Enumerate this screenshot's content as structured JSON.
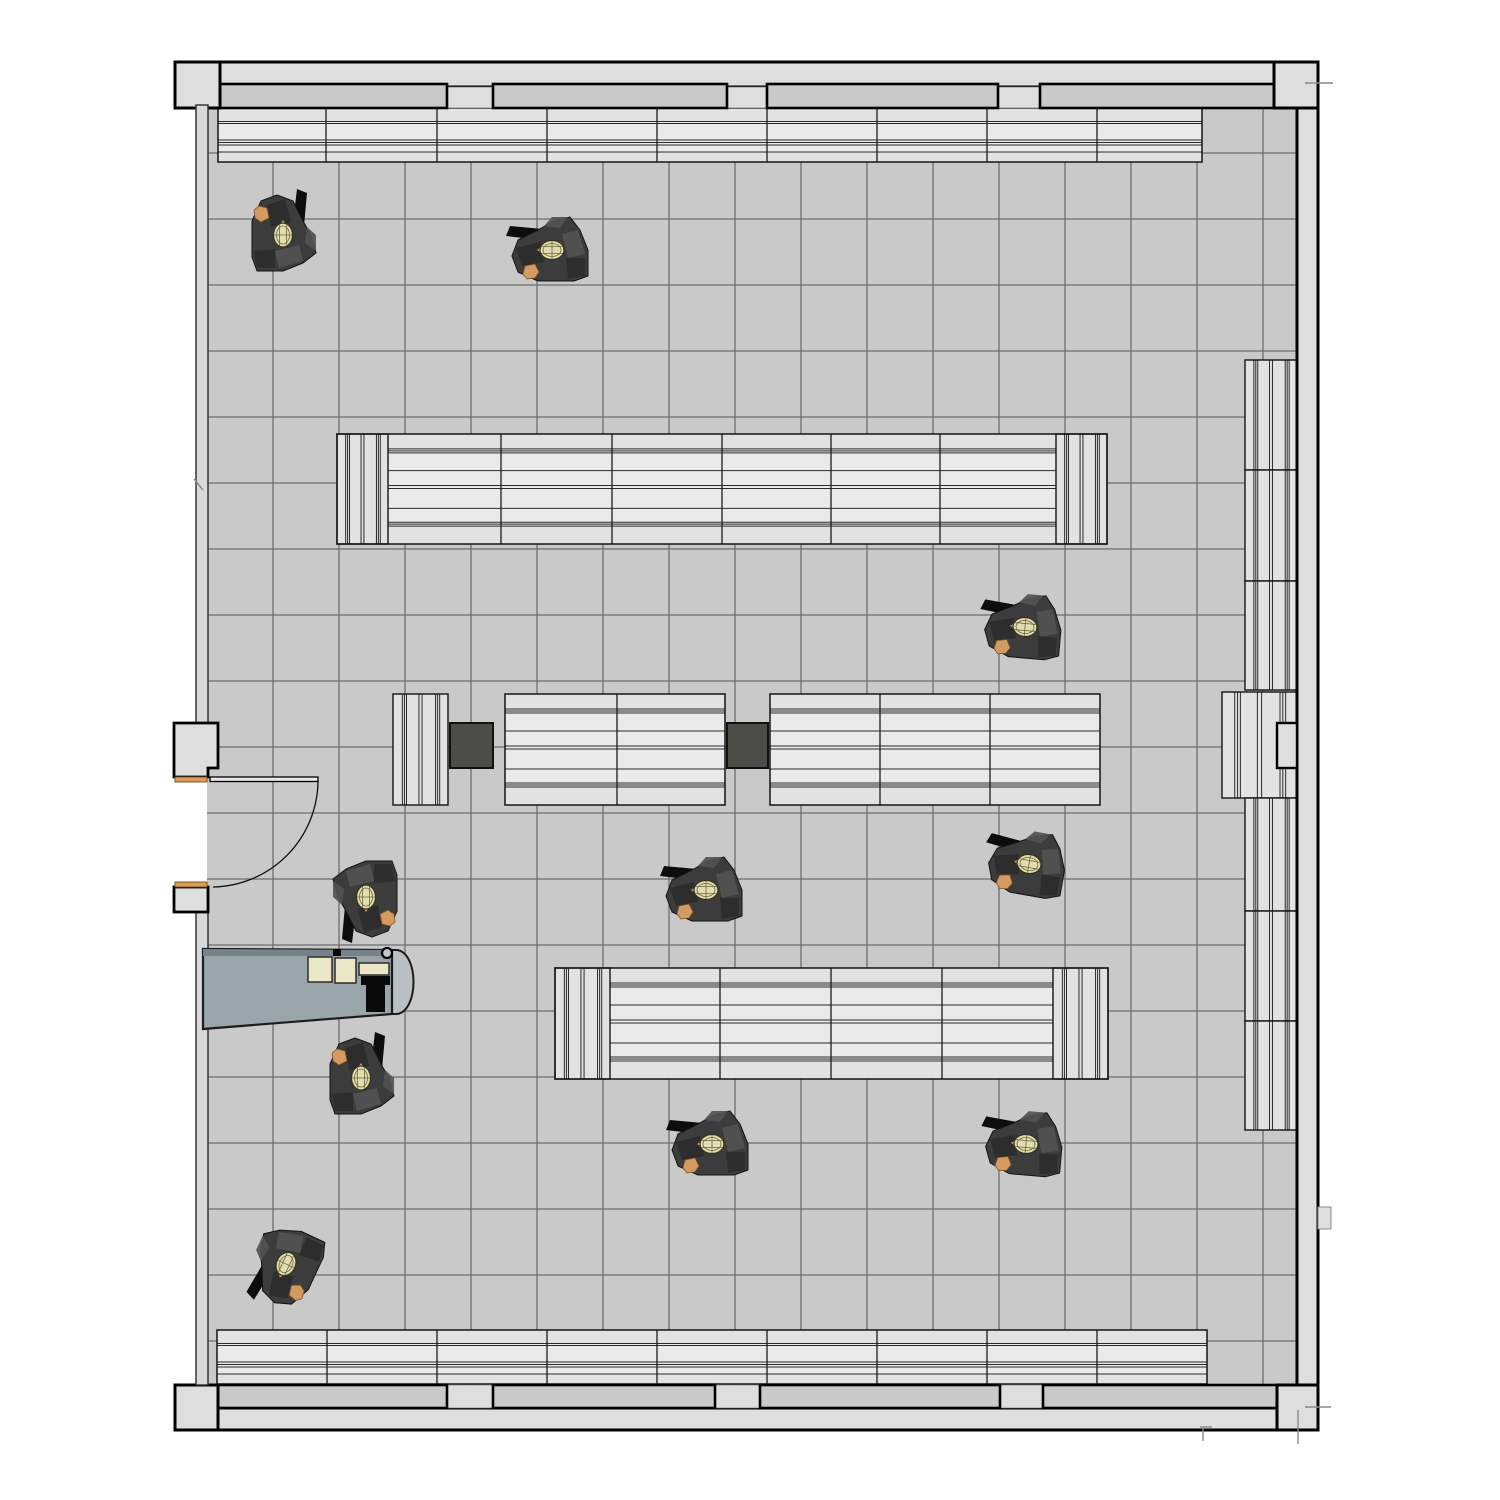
{
  "scene": {
    "width": 1500,
    "height": 1500
  },
  "colors": {
    "bg": "#ffffff",
    "floor": "#c9c9c9",
    "grid": "#565656",
    "wall_fill": "#dedede",
    "wall_stroke": "#000000",
    "pillar_fill": "#c9c9c9",
    "left_wall_fill": "#d9d9d9",
    "shelf_fill": "#e2e2e2",
    "shelf_inner": "#eaeaea",
    "shelf_stroke": "#141414",
    "shelf_line": "#2b2b2b",
    "dark_block": "#4c4c49",
    "desk_fill": "#9aa5a9",
    "desk_edge": "#77838a",
    "desk_cap": "#b9bfc2",
    "desk_stroke": "#1c1c1c",
    "cream": "#ebe6c5",
    "black": "#0a0a0a",
    "door_frame_orange": "#d99e5e",
    "person_body": "#3c3c3c",
    "person_body_light": "#525252",
    "person_body_dark": "#2c2c2c",
    "person_head": "#e1ddae",
    "person_head_line": "#6b663c",
    "person_hand": "#d49b61",
    "person_arm": "#0d0d0d",
    "tick": "#8a8a8a"
  },
  "floor": {
    "x": 207,
    "y": 87,
    "w": 1090,
    "h": 1321,
    "grid_x0": 273,
    "grid_x1": 1263,
    "grid_y0": 153,
    "grid_y1": 1341,
    "step": 66,
    "top": 108,
    "bottom": 1385,
    "left": 207,
    "right": 1297
  },
  "walls": {
    "bands": [
      [
        175,
        62,
        1143,
        25
      ],
      [
        1297,
        62,
        21,
        1368
      ],
      [
        175,
        1408,
        1143,
        22
      ]
    ],
    "corner_blocks": [
      [
        175,
        62,
        45,
        46
      ],
      [
        1274,
        62,
        44,
        46
      ],
      [
        175,
        1385,
        43,
        45
      ],
      [
        1277,
        1385,
        41,
        45
      ]
    ],
    "notch_blocks": [
      [
        1277,
        723,
        20,
        45
      ]
    ],
    "pillars_top": [
      [
        220,
        84,
        227,
        24
      ],
      [
        493,
        84,
        234,
        24
      ],
      [
        767,
        84,
        231,
        24
      ],
      [
        1040,
        84,
        234,
        24
      ]
    ],
    "pillars_bottom": [
      [
        218,
        1385,
        229,
        23
      ],
      [
        493,
        1385,
        222,
        23
      ],
      [
        760,
        1385,
        240,
        23
      ],
      [
        1043,
        1385,
        234,
        23
      ]
    ],
    "gap_strips": [
      [
        447,
        87,
        46,
        21
      ],
      [
        727,
        87,
        40,
        21
      ],
      [
        998,
        87,
        42,
        21
      ],
      [
        1274,
        87,
        23,
        21
      ],
      [
        447,
        1385,
        46,
        23
      ],
      [
        715,
        1385,
        45,
        23
      ],
      [
        1000,
        1385,
        43,
        23
      ]
    ],
    "left_wall": [
      [
        196,
        105,
        12,
        618
      ],
      [
        196,
        909,
        12,
        476
      ]
    ],
    "entry_box_top_poly": [
      [
        174,
        723
      ],
      [
        218,
        723
      ],
      [
        218,
        768
      ],
      [
        208,
        768
      ],
      [
        208,
        777
      ],
      [
        174,
        777
      ]
    ],
    "entry_box_bottom": [
      174,
      887,
      34,
      25
    ],
    "door_frame_strips": [
      [
        175,
        777,
        32,
        5
      ],
      [
        175,
        882,
        32,
        5
      ]
    ],
    "outside_block": [
      1318,
      1207,
      13,
      22
    ],
    "ticks": [
      [
        1305,
        83,
        1333,
        83
      ],
      [
        194,
        479,
        203,
        490
      ],
      [
        1200,
        1427,
        1212,
        1427
      ],
      [
        1203,
        1427,
        1203,
        1441
      ],
      [
        1298,
        1410,
        1298,
        1444
      ],
      [
        1305,
        1407,
        1331,
        1407
      ]
    ]
  },
  "door": {
    "leaf": [
      210,
      777,
      108,
      4.5
    ],
    "arc_from": [
      318,
      781
    ],
    "arc_to": [
      213,
      887
    ],
    "radius": 107
  },
  "patterns": {
    "short": {
      "ref": 54,
      "lines": [
        13.5,
        15.5,
        32,
        34.5,
        37,
        44
      ]
    },
    "tall": {
      "ref": 111,
      "lines": [
        15,
        17,
        19,
        37,
        52,
        55,
        75,
        89,
        91,
        93
      ]
    },
    "cap": {
      "ref": 53,
      "lines": [
        9,
        11,
        13,
        25,
        28,
        41,
        43,
        45
      ]
    }
  },
  "shelves_h": [
    {
      "x": 218,
      "y": 108,
      "w": 984,
      "h": 54,
      "capL": false,
      "capR": false,
      "capW": 0,
      "dividers": [
        326,
        437,
        547,
        657,
        767,
        877,
        987,
        1097
      ],
      "pattern": "short"
    },
    {
      "x": 337,
      "y": 434,
      "w": 770,
      "h": 110,
      "capL": true,
      "capR": true,
      "capW": 51,
      "dividers": [
        501,
        612,
        722,
        831,
        940
      ],
      "pattern": "tall"
    },
    {
      "x": 505,
      "y": 694,
      "w": 220,
      "h": 111,
      "capL": false,
      "capR": false,
      "capW": 0,
      "dividers": [
        617
      ],
      "pattern": "tall"
    },
    {
      "x": 770,
      "y": 694,
      "w": 330,
      "h": 111,
      "capL": false,
      "capR": false,
      "capW": 0,
      "dividers": [
        880,
        990
      ],
      "pattern": "tall"
    },
    {
      "x": 555,
      "y": 968,
      "w": 553,
      "h": 111,
      "capL": true,
      "capR": true,
      "capW": 55,
      "dividers": [
        720,
        831,
        942
      ],
      "pattern": "tall"
    },
    {
      "x": 217,
      "y": 1330,
      "w": 990,
      "h": 54,
      "capL": false,
      "capR": false,
      "capW": 0,
      "dividers": [
        327,
        437,
        547,
        657,
        767,
        877,
        987,
        1097
      ],
      "pattern": "short"
    }
  ],
  "shelves_v": [
    {
      "x": 393,
      "y": 694,
      "w": 55,
      "h": 111
    },
    {
      "x": 1245,
      "y": 360,
      "w": 52,
      "h": 110
    },
    {
      "x": 1245,
      "y": 470,
      "w": 52,
      "h": 111
    },
    {
      "x": 1245,
      "y": 581,
      "w": 52,
      "h": 109
    },
    {
      "x": 1222,
      "y": 692,
      "w": 75,
      "h": 106
    },
    {
      "x": 1245,
      "y": 798,
      "w": 52,
      "h": 113
    },
    {
      "x": 1245,
      "y": 911,
      "w": 52,
      "h": 110
    },
    {
      "x": 1245,
      "y": 1021,
      "w": 52,
      "h": 109
    }
  ],
  "dark_blocks": [
    [
      450,
      723,
      43,
      45
    ],
    [
      727,
      723,
      41,
      45
    ]
  ],
  "desk": {
    "main_poly": [
      [
        203,
        949
      ],
      [
        392,
        950
      ],
      [
        392,
        1014
      ],
      [
        203,
        1029
      ]
    ],
    "edge_poly": [
      [
        203,
        949
      ],
      [
        392,
        950
      ],
      [
        392,
        956
      ],
      [
        203,
        956
      ]
    ],
    "cap": {
      "x": 392,
      "y1": 950,
      "y2": 1014,
      "bulge": 27
    },
    "papers": [
      [
        308,
        957,
        24,
        25
      ],
      [
        335,
        958,
        21,
        25
      ]
    ],
    "keyboard": [
      359,
      963,
      30,
      12
    ],
    "monitor_bar": [
      361,
      976,
      29,
      9
    ],
    "monitor_stem": [
      366,
      985,
      19,
      27
    ],
    "small_black": [
      333,
      949,
      8,
      7
    ],
    "cup": {
      "cx": 387,
      "cy": 953,
      "r": 5
    }
  },
  "people": [
    {
      "x": 283,
      "y": 235,
      "rot": 180
    },
    {
      "x": 552,
      "y": 250,
      "rot": 90
    },
    {
      "x": 1025,
      "y": 627,
      "rot": 95
    },
    {
      "x": 366,
      "y": 897,
      "rot": 0
    },
    {
      "x": 706,
      "y": 890,
      "rot": 90
    },
    {
      "x": 1029,
      "y": 864,
      "rot": 100
    },
    {
      "x": 361,
      "y": 1078,
      "rot": 180
    },
    {
      "x": 712,
      "y": 1144,
      "rot": 90
    },
    {
      "x": 1026,
      "y": 1144,
      "rot": 95
    },
    {
      "x": 286,
      "y": 1264,
      "rot": 25
    }
  ]
}
